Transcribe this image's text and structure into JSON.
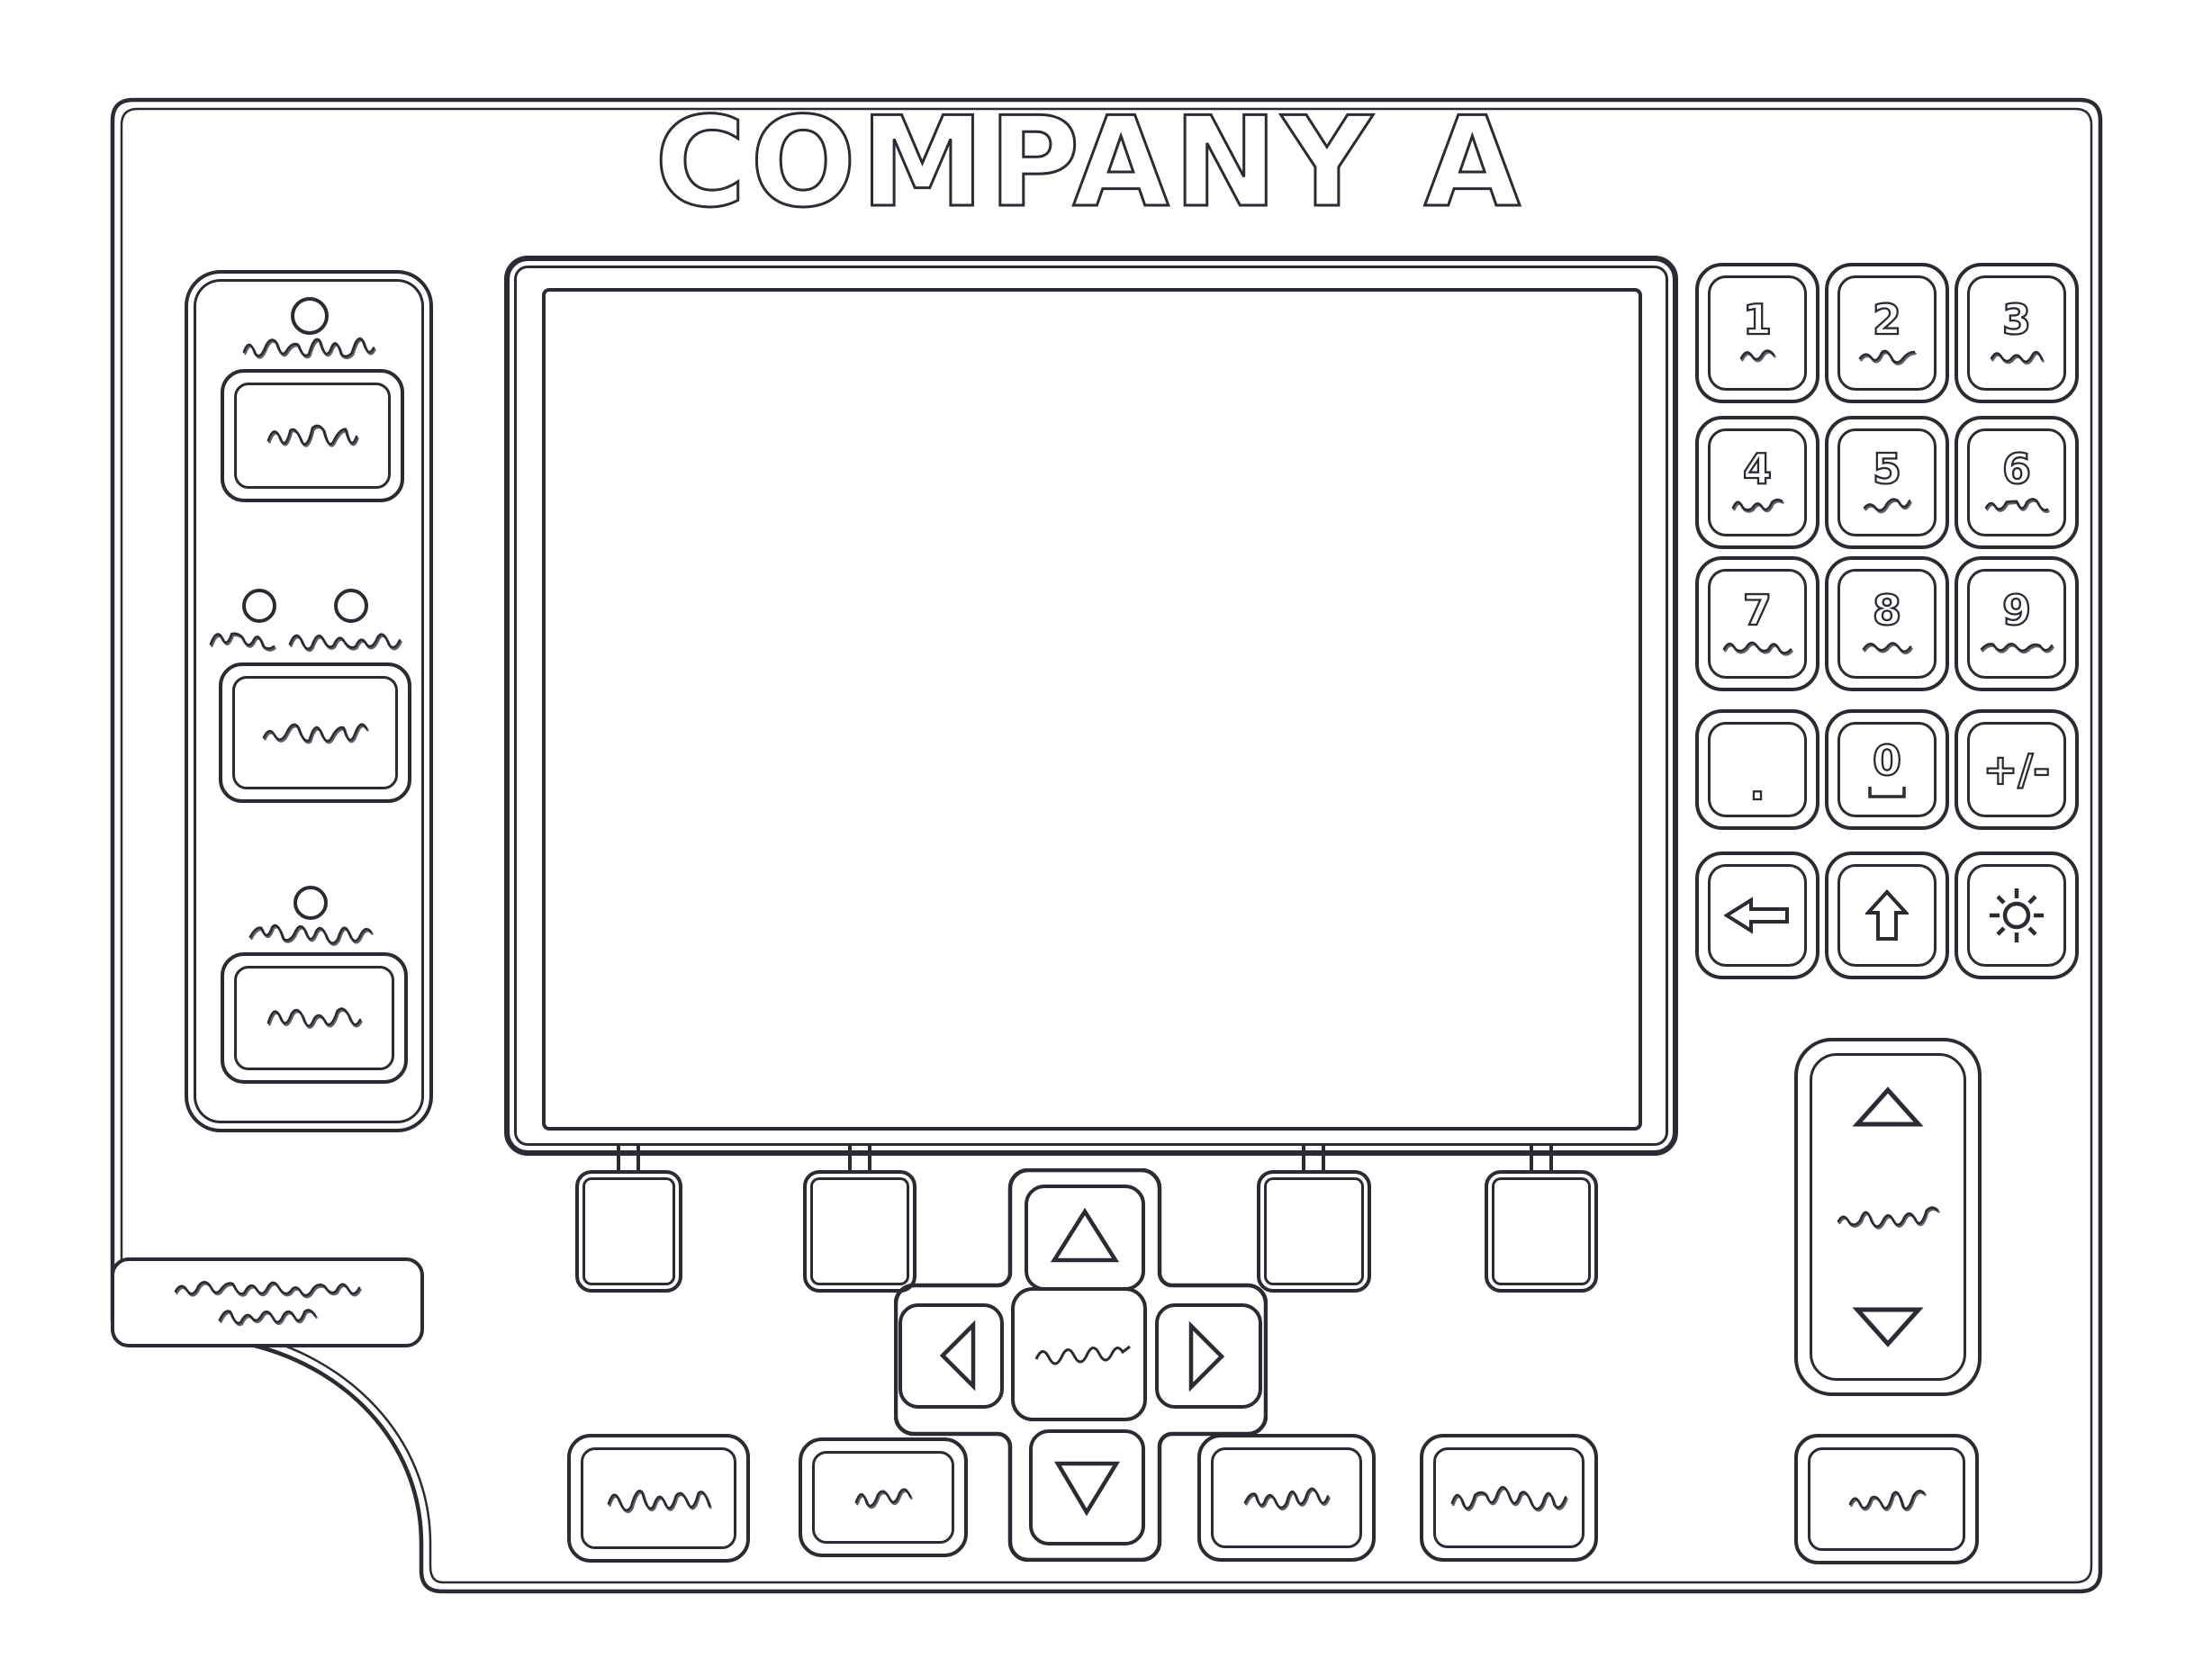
{
  "header": {
    "title": "COMPANY A"
  },
  "keypad": {
    "keys": [
      {
        "id": "1",
        "label": "1"
      },
      {
        "id": "2",
        "label": "2"
      },
      {
        "id": "3",
        "label": "3"
      },
      {
        "id": "4",
        "label": "4"
      },
      {
        "id": "5",
        "label": "5"
      },
      {
        "id": "6",
        "label": "6"
      },
      {
        "id": "7",
        "label": "7"
      },
      {
        "id": "8",
        "label": "8"
      },
      {
        "id": "9",
        "label": "9"
      },
      {
        "id": "decimal",
        "label": "."
      },
      {
        "id": "0",
        "label": "0"
      },
      {
        "id": "plus-minus",
        "label": "+/-"
      }
    ],
    "icon_keys": [
      "backspace-arrow-icon",
      "shift-up-arrow-icon",
      "brightness-sun-icon"
    ]
  },
  "nav_icons": [
    "up-triangle-icon",
    "left-triangle-icon",
    "menu-label-scribble",
    "right-triangle-icon",
    "down-triangle-icon"
  ],
  "adjust_icons": [
    "up-triangle-icon",
    "adjust-label-scribble",
    "down-triangle-icon"
  ],
  "colors": {
    "ink": "#2b2b33",
    "paper": "#ffffff"
  }
}
